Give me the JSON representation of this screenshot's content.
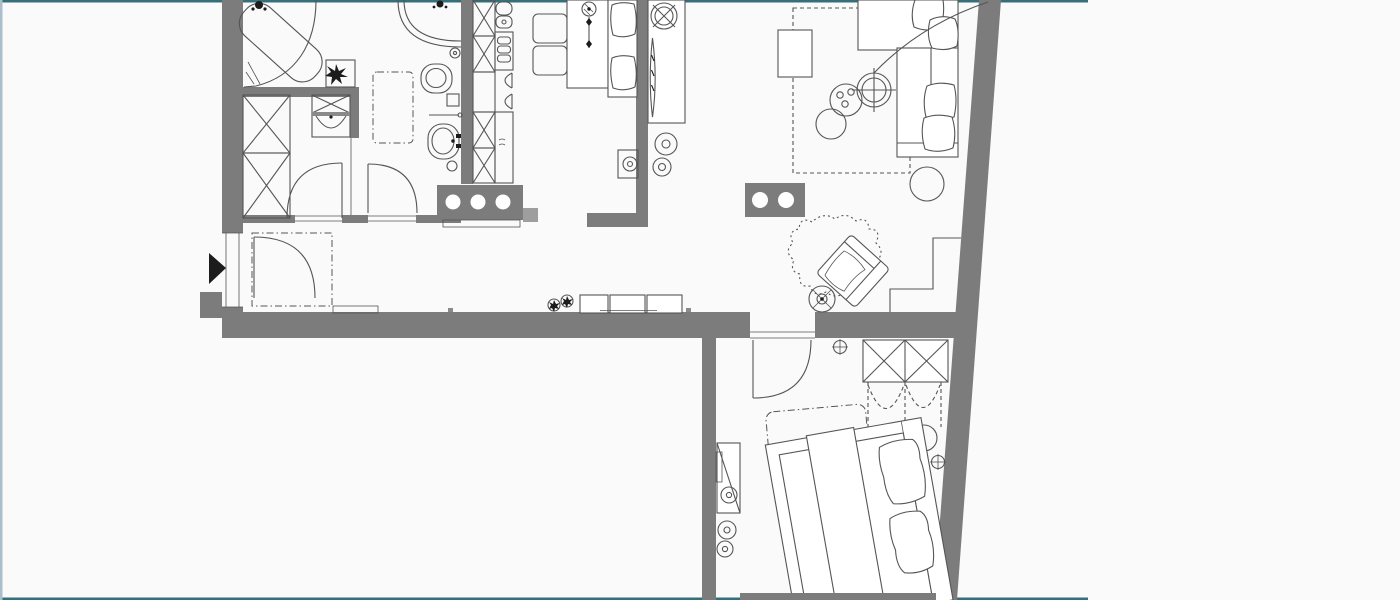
{
  "window": {
    "width": 1400,
    "height": 600
  },
  "colors": {
    "background": "#fbfafa",
    "floor": "#fbfafa",
    "wall": "#7c7c7c",
    "wall_light": "#9e9e9e",
    "line": "#555555",
    "dark": "#1c1c1c",
    "white": "#ffffff",
    "border_top": "#35707a",
    "border_bottom": "#35707a",
    "border_left": "#aabfca"
  },
  "floor_plan": {
    "type": "apartment-floor-plan",
    "entrance_marker": "black-triangle-pointing-right",
    "fixtures": [
      "corner-bathtub",
      "corner-shower",
      "toilet",
      "bathroom-sink",
      "towel-rail",
      "bath-plant",
      "bath-rug",
      "washing-machine",
      "wardrobe-x-units",
      "kitchen-tall-cabinets",
      "kitchen-sink",
      "kitchen-oven",
      "cabinet-doors",
      "cooktop-island-3-burners",
      "counter-block-2-circles",
      "dining-table",
      "dining-chairs",
      "dining-bench",
      "pendant-lamp",
      "ceiling-fan",
      "sideboard",
      "tall-leaf-plant",
      "side-tables",
      "corner-sofa",
      "sofa-pillows",
      "coffee-table",
      "arc-floor-lamp",
      "round-plant",
      "pouf",
      "living-rug",
      "armchair",
      "organic-rug",
      "floor-lamp",
      "wall-steps",
      "entry-door",
      "laundry-door",
      "bathroom-door",
      "bedroom-door",
      "entry-rug",
      "doormat",
      "shoe-bench",
      "hall-plants",
      "bedroom-wardrobe",
      "wardrobe-swing-dashes",
      "double-bed",
      "bed-pillows",
      "bed-blanket",
      "bedside-round-table",
      "bedroom-rug",
      "desk",
      "stools",
      "wall-symbols"
    ]
  }
}
